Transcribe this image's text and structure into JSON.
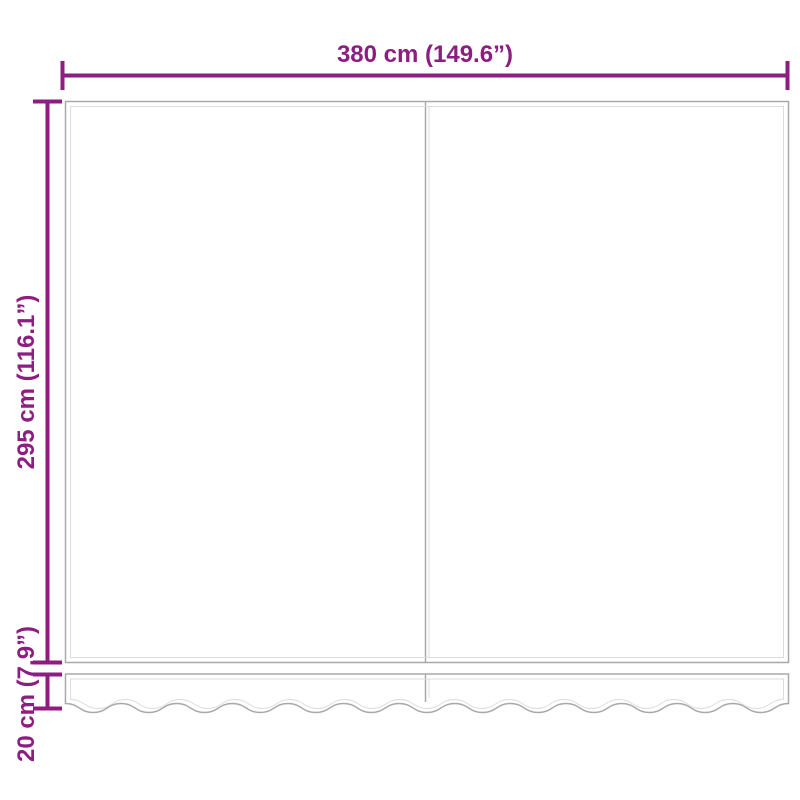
{
  "labels": {
    "width": "380 cm (149.6”)",
    "height": "295 cm (116.1”)",
    "valance_height": "20 cm (7.9”)"
  },
  "colors": {
    "dimension": "#8e1d82",
    "outline": "#a9a9a9",
    "outline_inner": "#dcdcdc",
    "background": "#ffffff"
  }
}
